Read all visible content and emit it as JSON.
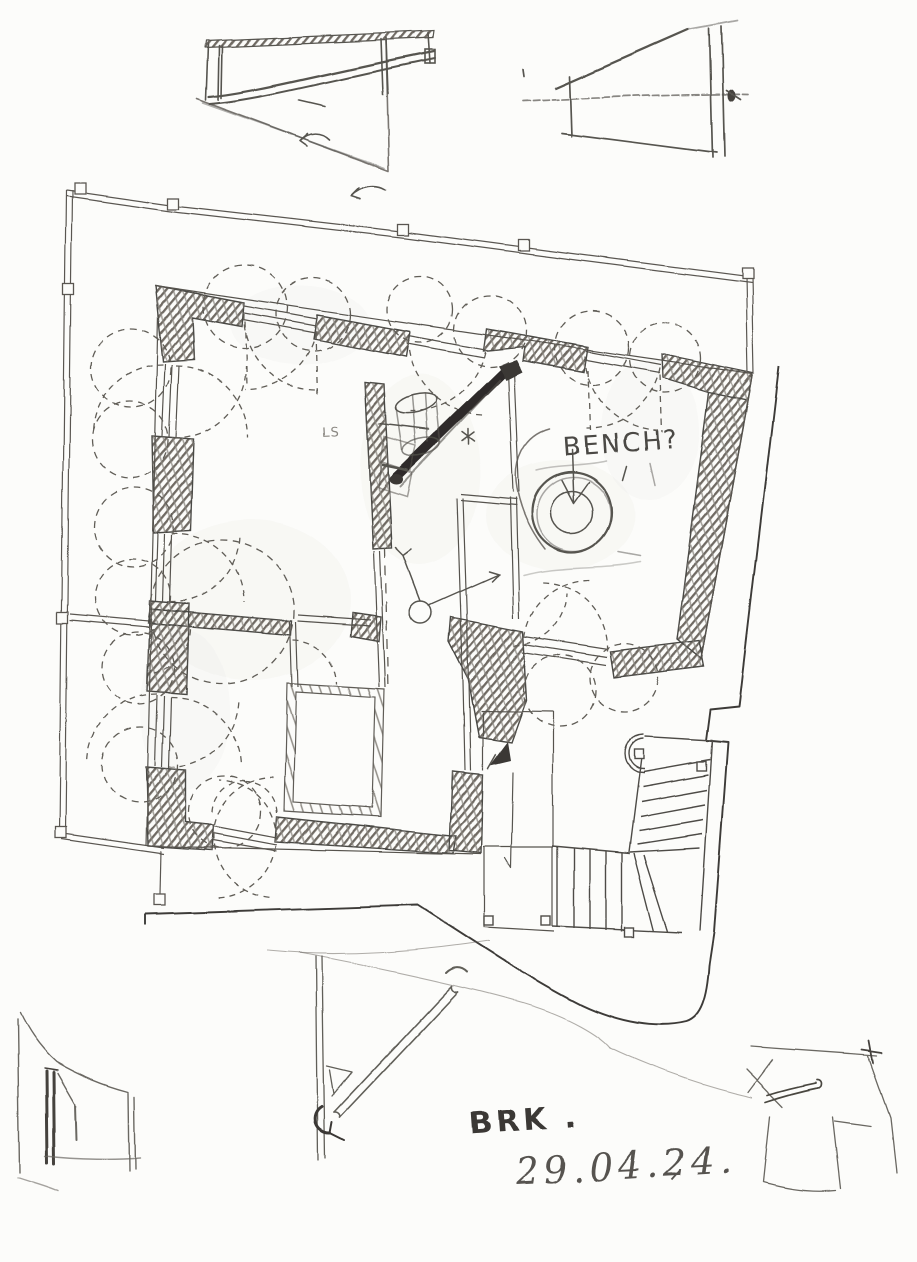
{
  "drawing": {
    "title": "hand-drawn architectural floor plan sketch",
    "annotations": {
      "bench_note": "BENCH?",
      "corner_note": "LS",
      "author_initials": "BRK .",
      "date": "29.04.24."
    },
    "colors": {
      "paper": "#fcfcfa",
      "pencil_light": "#8f8c86",
      "pencil_mid": "#57544f",
      "pencil_dark": "#34322f"
    }
  }
}
